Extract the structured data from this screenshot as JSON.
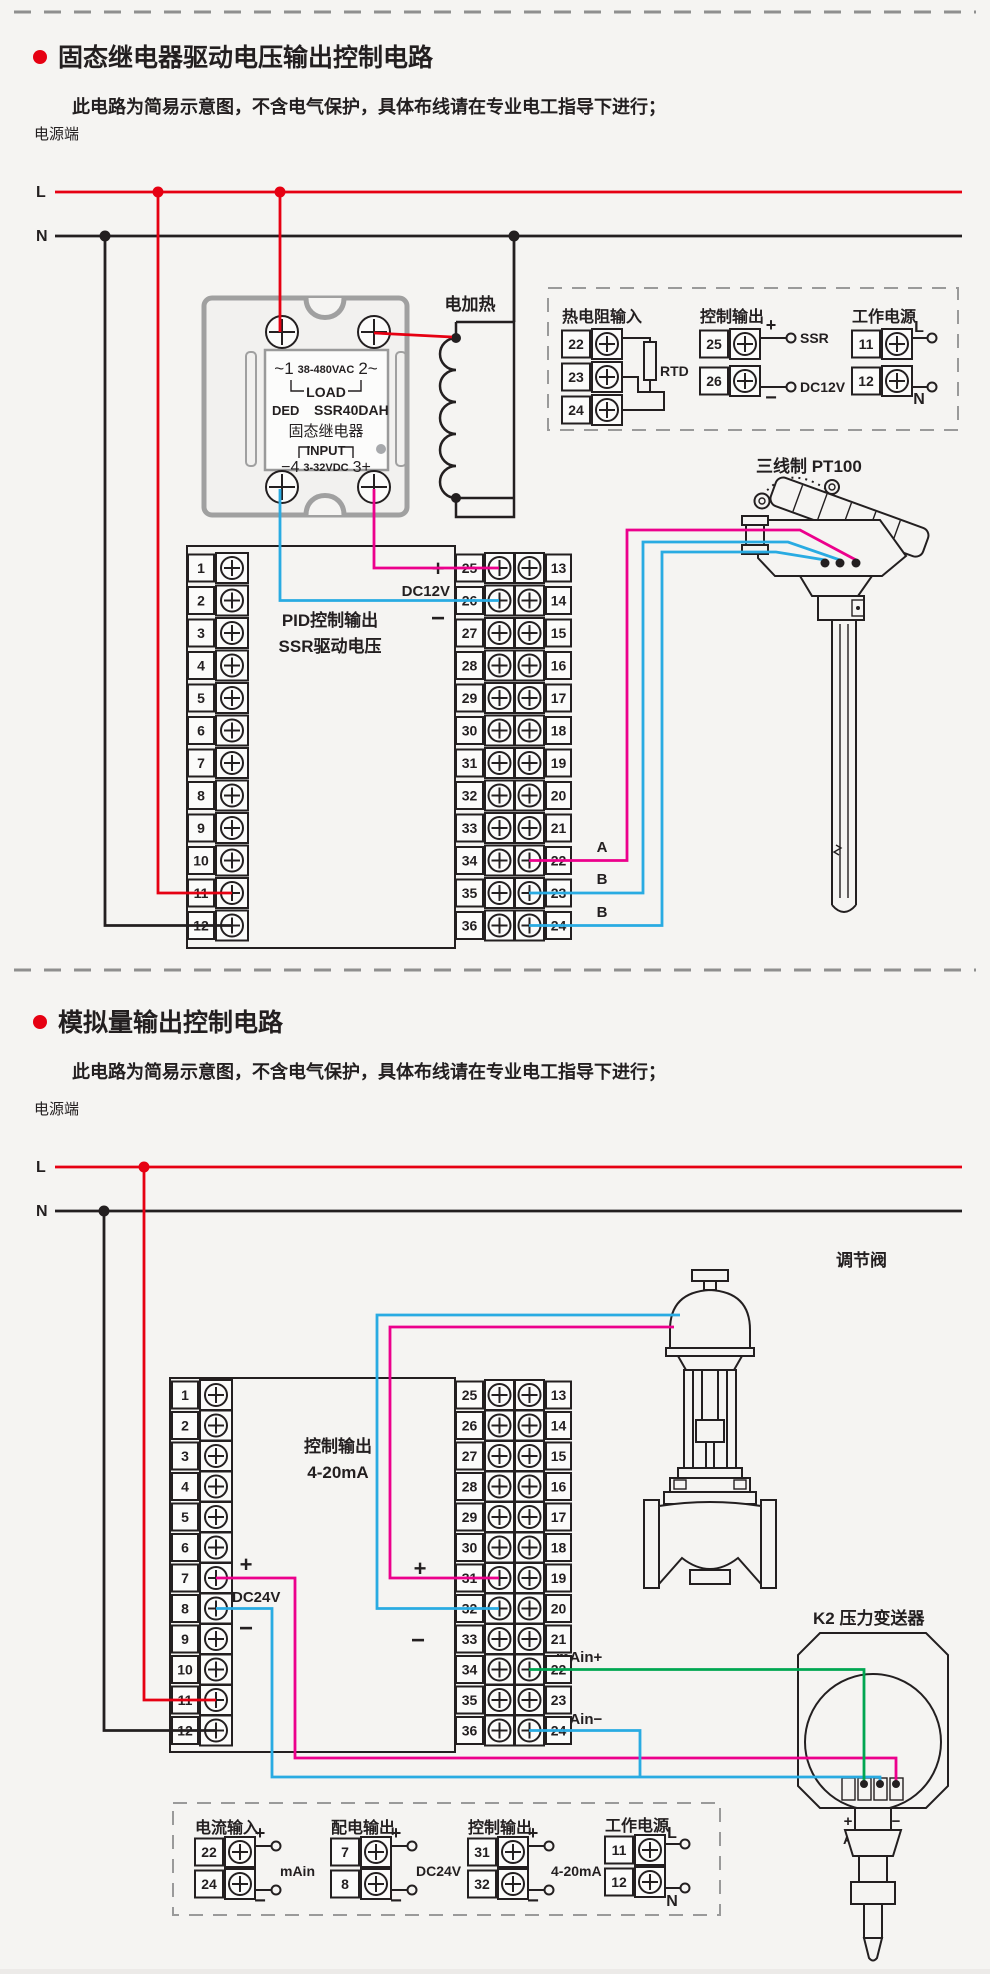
{
  "colors": {
    "red": "#e60012",
    "magenta": "#ec008c",
    "blue": "#29abe2",
    "green": "#00a651",
    "ink": "#231f20",
    "gray": "#9a9a9a"
  },
  "section1": {
    "title": "固态继电器驱动电压输出控制电路",
    "note": "此电路为简易示意图，不含电气保护，具体布线请在专业电工指导下进行；",
    "power_label": "电源端",
    "line_l": "L",
    "line_n": "N",
    "ssr": {
      "ac1": "~1",
      "ac_rating": "38-480VAC",
      "ac2": "2~",
      "load": "LOAD",
      "brand": "DED",
      "model": "SSR40DAH",
      "name": "固态继电器",
      "input": "INPUT",
      "dc_minus": "−4",
      "dc_rating": "3-32VDC",
      "dc_plus": "3+"
    },
    "heater_label": "电加热",
    "controller": {
      "left_numbers": [
        "1",
        "2",
        "3",
        "4",
        "5",
        "6",
        "7",
        "8",
        "9",
        "10",
        "11",
        "12"
      ],
      "inner_numbers": [
        "25",
        "26",
        "27",
        "28",
        "29",
        "30",
        "31",
        "32",
        "33",
        "34",
        "35",
        "36"
      ],
      "outer_numbers": [
        "13",
        "14",
        "15",
        "16",
        "17",
        "18",
        "19",
        "20",
        "21",
        "22",
        "23",
        "24"
      ],
      "out_plus": "+",
      "out_voltage": "DC12V",
      "out_minus": "−",
      "mid_line1": "PID控制输出",
      "mid_line2": "SSR驱动电压",
      "wire_a": "A",
      "wire_b1": "B",
      "wire_b2": "B"
    },
    "legend": {
      "rtd": {
        "title": "热电阻输入",
        "t1": "22",
        "t2": "23",
        "t3": "24",
        "label": "RTD"
      },
      "out": {
        "title": "控制输出",
        "t1": "25",
        "t2": "26",
        "plus": "+",
        "minus": "−",
        "l1": "SSR",
        "l2": "DC12V"
      },
      "pwr": {
        "title": "工作电源",
        "t1": "11",
        "t2": "12",
        "l1": "L",
        "l2": "N"
      }
    },
    "sensor_label": "三线制 PT100"
  },
  "section2": {
    "title": "模拟量输出控制电路",
    "note": "此电路为简易示意图，不含电气保护，具体布线请在专业电工指导下进行；",
    "power_label": "电源端",
    "line_l": "L",
    "line_n": "N",
    "controller": {
      "left_numbers": [
        "1",
        "2",
        "3",
        "4",
        "5",
        "6",
        "7",
        "8",
        "9",
        "10",
        "11",
        "12"
      ],
      "inner_numbers": [
        "25",
        "26",
        "27",
        "28",
        "29",
        "30",
        "31",
        "32",
        "33",
        "34",
        "35",
        "36"
      ],
      "outer_numbers": [
        "13",
        "14",
        "15",
        "16",
        "17",
        "18",
        "19",
        "20",
        "21",
        "22",
        "23",
        "24"
      ],
      "mid_line1": "控制输出",
      "mid_line2": "4-20mA",
      "sup_plus": "+",
      "sup_voltage": "DC24V",
      "sup_minus": "−",
      "out_plus": "+",
      "out_minus": "−",
      "main_plus": "mAin+",
      "main_minus": "mAin−"
    },
    "valve_label": "调节阀",
    "transmitter": {
      "label": "K2 压力变送器",
      "p1": "+",
      "m1": "−",
      "p2": "+",
      "m2": "−",
      "a": "A",
      "b": "B"
    },
    "legend": {
      "cur": {
        "title": "电流输入",
        "t1": "22",
        "t2": "24",
        "plus": "+",
        "minus": "−",
        "label": "mAin"
      },
      "sup": {
        "title": "配电输出",
        "t1": "7",
        "t2": "8",
        "plus": "+",
        "minus": "−",
        "label": "DC24V"
      },
      "out": {
        "title": "控制输出",
        "t1": "31",
        "t2": "32",
        "plus": "+",
        "minus": "−",
        "label": "4-20mA"
      },
      "pwr": {
        "title": "工作电源",
        "t1": "11",
        "t2": "12",
        "l1": "L",
        "l2": "N"
      }
    }
  }
}
